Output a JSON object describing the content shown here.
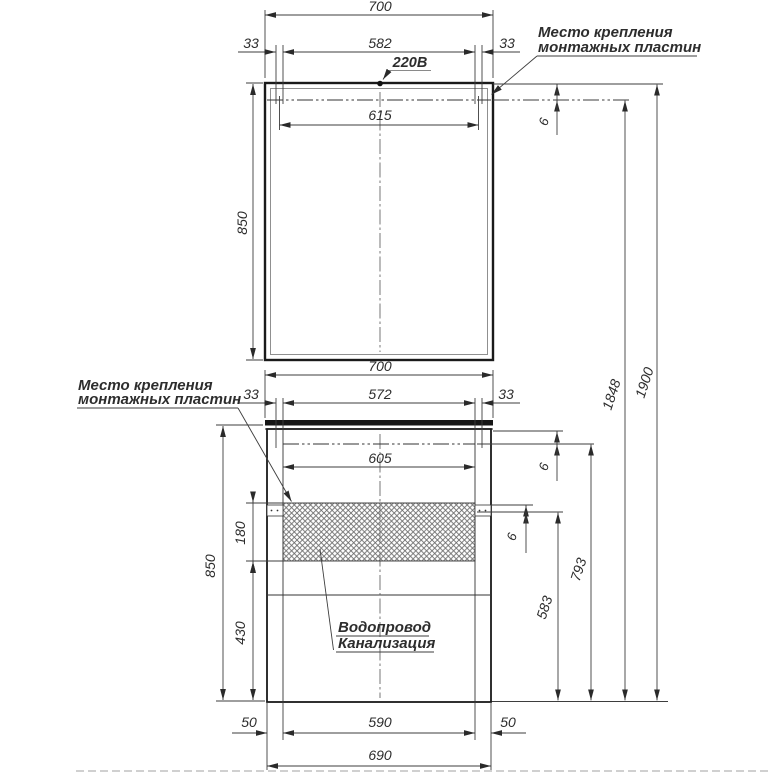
{
  "drawing": {
    "mirror_unit": {
      "overall_width": "700",
      "plate_gap_width": "582",
      "offset_left": "33",
      "offset_right": "33",
      "plate_center_span": "615",
      "height": "850",
      "plate_top_offset": "6",
      "power_label": "220В"
    },
    "cabinet_unit": {
      "overall_width": "700",
      "plate_gap_width": "572",
      "offset_left": "33",
      "offset_right": "33",
      "plate_center_span": "605",
      "height": "850",
      "service_zone_height": "180",
      "bottom_zone_height": "430",
      "plate_top_offset": "6",
      "plate_zone_offset": "6",
      "foot_left": "50",
      "bottom_width": "590",
      "foot_right": "50",
      "base_width": "690",
      "plate_line_to_floor": "583",
      "counter_line_to_floor": "793"
    },
    "overall": {
      "mirror_plate_height": "1848",
      "total_height": "1900"
    },
    "annotations": {
      "mounting_top_line1": "Место крепления",
      "mounting_top_line2": "монтажных пластин",
      "mounting_left_line1": "Место крепления",
      "mounting_left_line2": "монтажных пластин",
      "plumbing_line1": "Водопровод",
      "plumbing_line2": "Канализация"
    }
  }
}
